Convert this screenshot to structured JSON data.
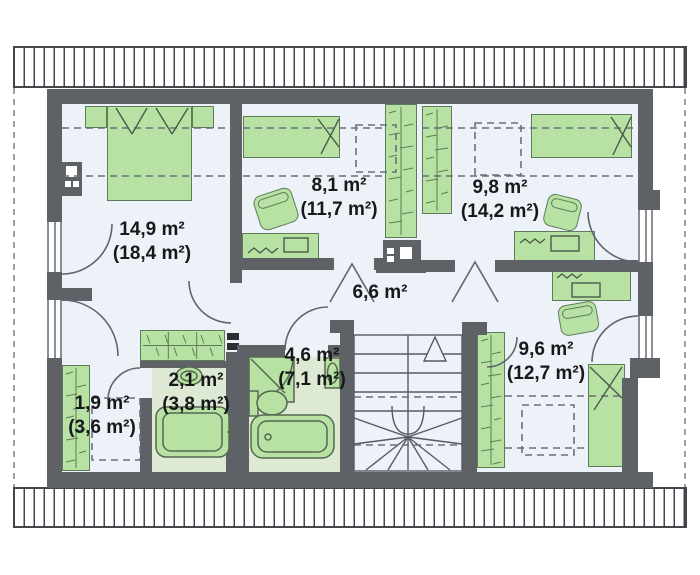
{
  "plan_title": "",
  "colors": {
    "wall": "#5e6166",
    "floor": "#edf1f8",
    "wet_floor": "#dde9d3",
    "furniture": "#b7e2a4",
    "furniture_outline": "#5f7b58",
    "hatch_line": "#43464b"
  },
  "rooms": [
    {
      "id": "bedroom-main",
      "area": "14,9 m²",
      "floor_area": "(18,4 m²)"
    },
    {
      "id": "room-left",
      "area": "8,1 m²",
      "floor_area": "(11,7 m²)"
    },
    {
      "id": "room-right",
      "area": "9,8 m²",
      "floor_area": "(14,2 m²)"
    },
    {
      "id": "hall",
      "area": "6,6 m²",
      "floor_area": ""
    },
    {
      "id": "bathroom",
      "area": "4,6 m²",
      "floor_area": "(7,1 m²)"
    },
    {
      "id": "wc",
      "area": "2,1 m²",
      "floor_area": "(3,8 m²)"
    },
    {
      "id": "closet",
      "area": "1,9 m²",
      "floor_area": "(3,6 m²)"
    },
    {
      "id": "bedroom-2",
      "area": "9,6 m²",
      "floor_area": "(12,7 m²)"
    }
  ]
}
